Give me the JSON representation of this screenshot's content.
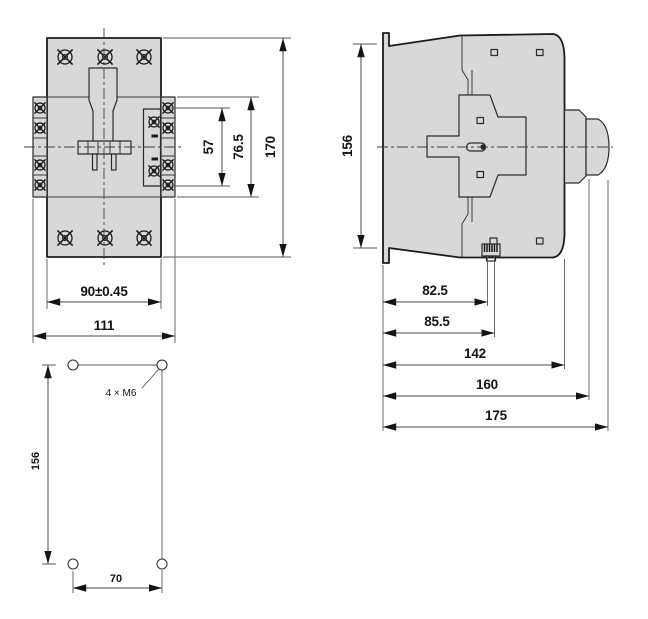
{
  "front_view": {
    "dims": {
      "aux_height": "57",
      "flange_height": "76.5",
      "overall_height": "170",
      "mounting_width": "90±0.45",
      "overall_width": "111"
    }
  },
  "side_view": {
    "dims": {
      "mounting_height": "156",
      "din_depth_inner": "82.5",
      "din_depth_outer": "85.5",
      "body_depth": "142",
      "terminal_depth": "160",
      "overall_depth": "175"
    }
  },
  "drilling_plan": {
    "hole_label": "4 × M6",
    "dims": {
      "vertical_pitch": "156",
      "horizontal_pitch": "70"
    }
  },
  "colors": {
    "body_fill": "#d8d8d8",
    "outline": "#1c1c1c",
    "dim_line": "#4a4a4a",
    "background": "#ffffff"
  }
}
